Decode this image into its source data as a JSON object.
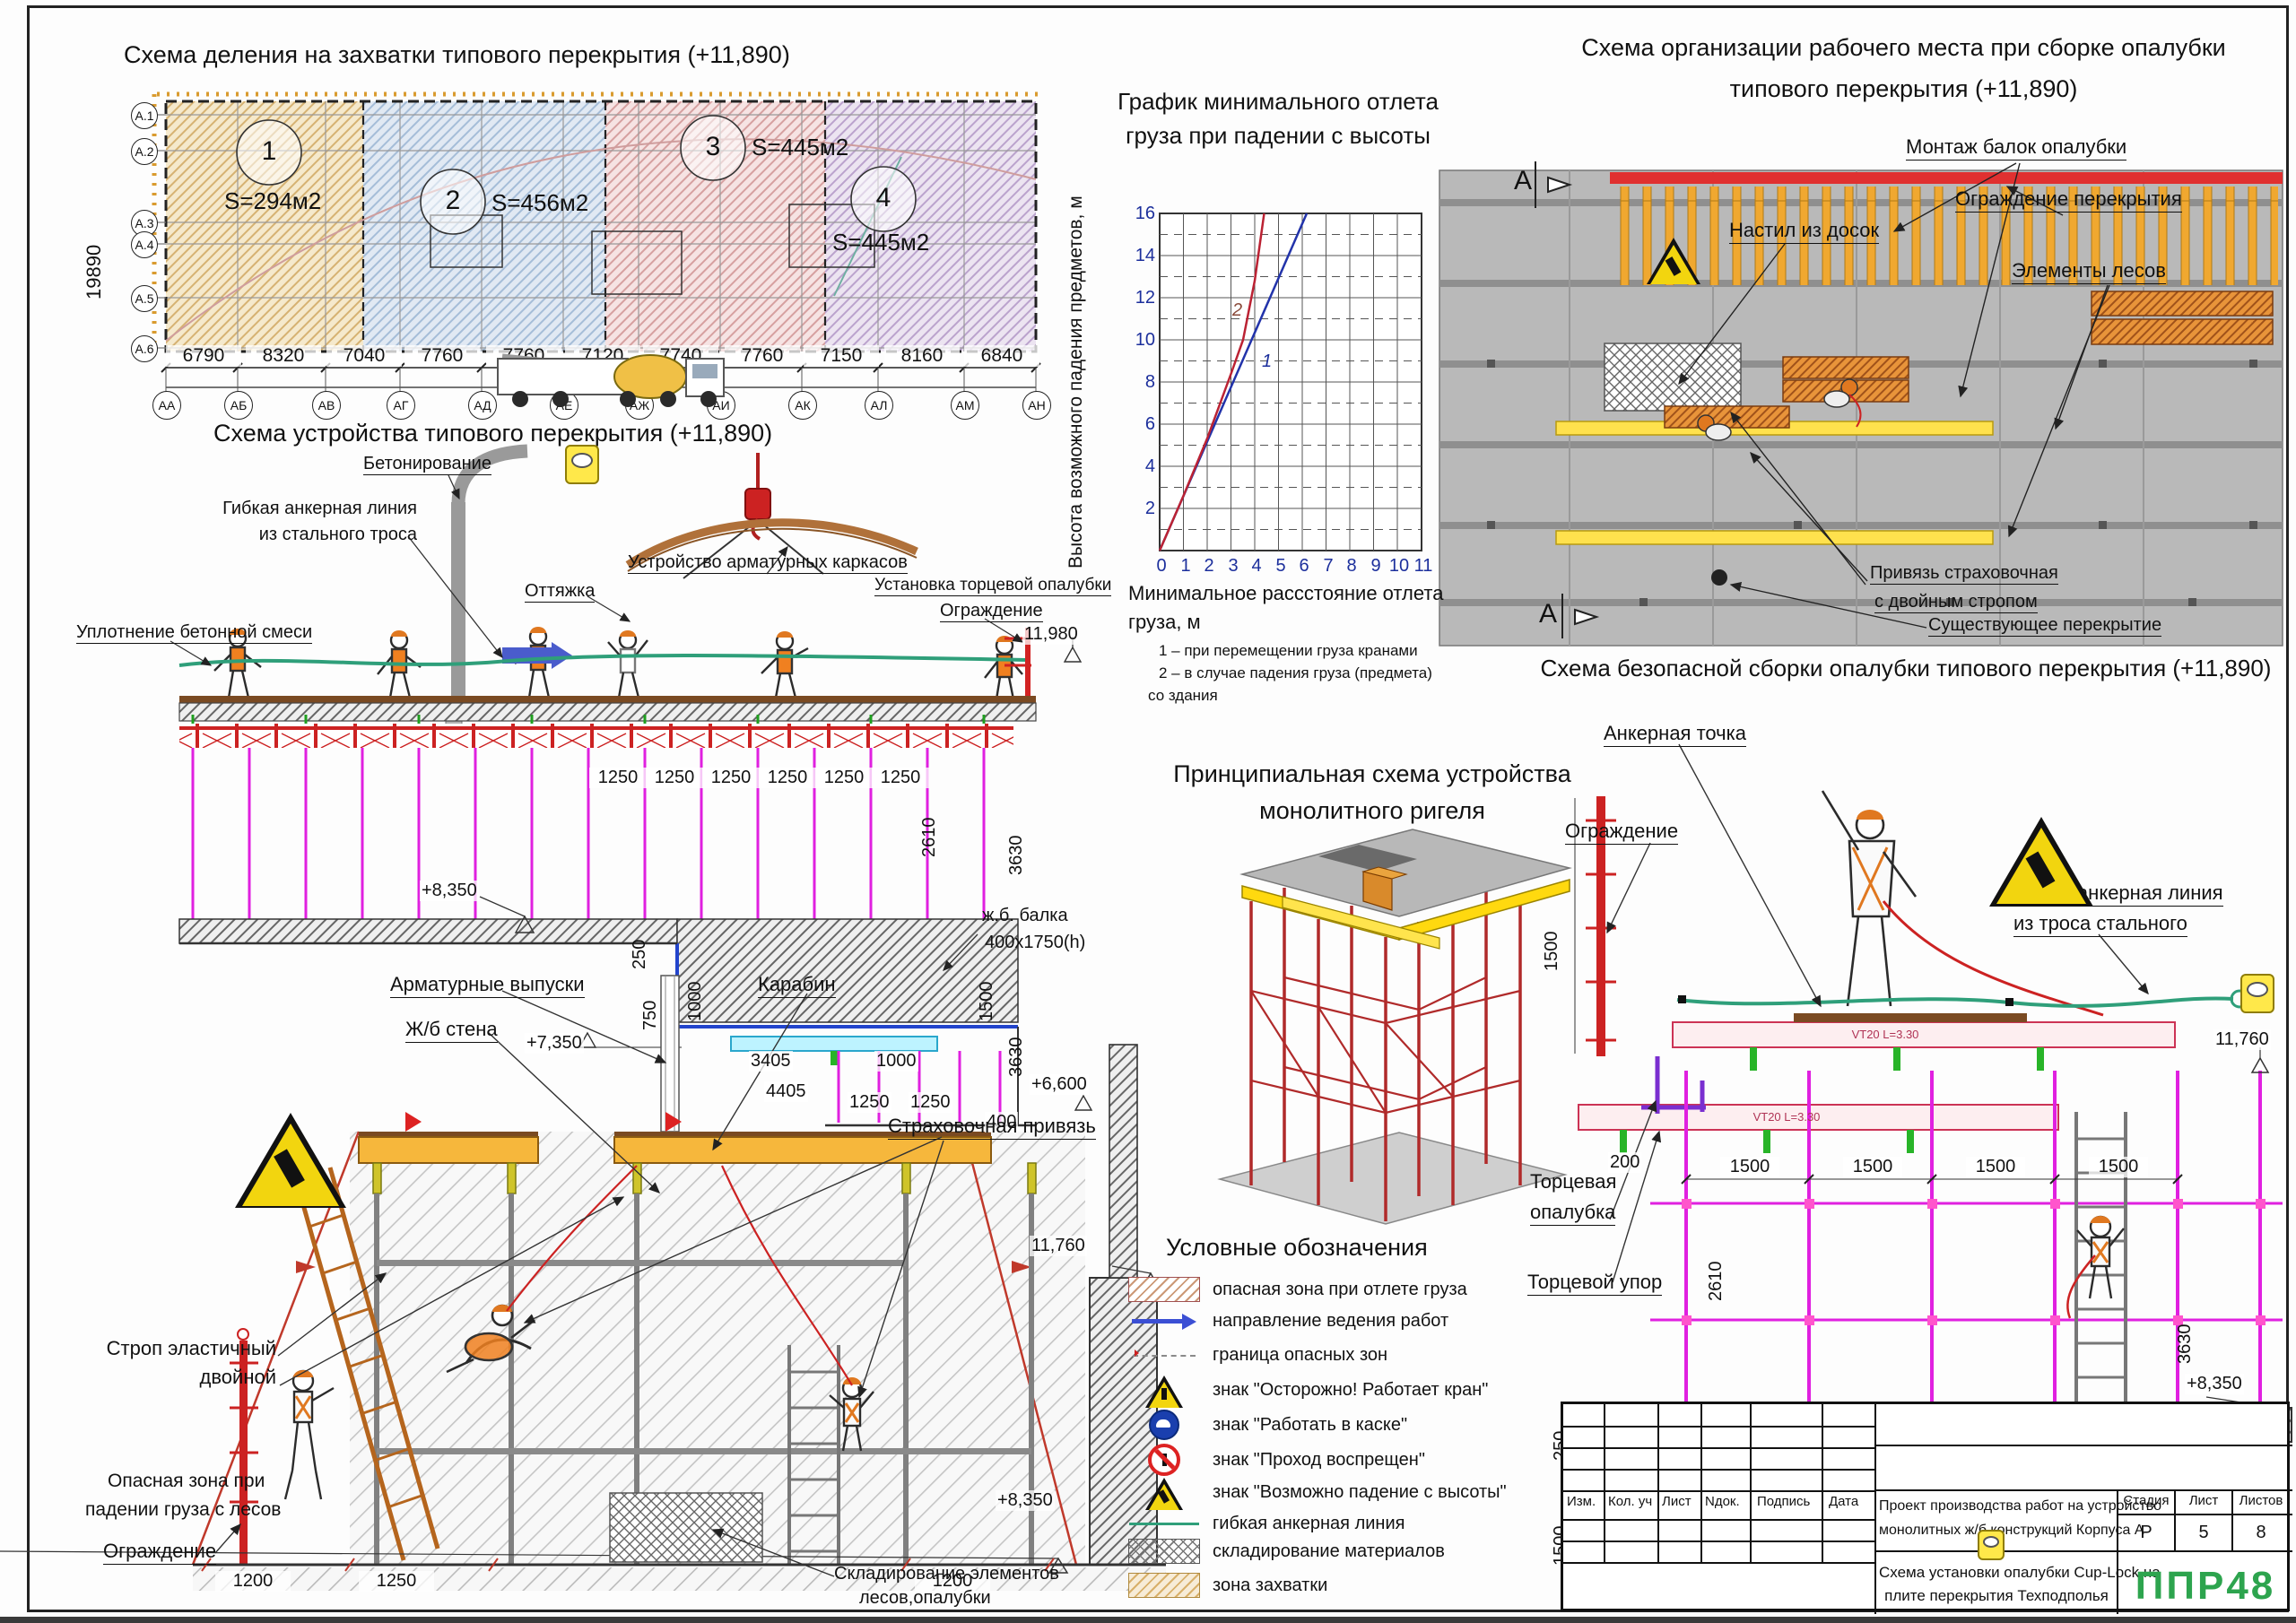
{
  "plan": {
    "title": "Схема деления на захватки типового перекрытия (+11,890)",
    "zones": [
      {
        "num": "1",
        "area": "S=294м2"
      },
      {
        "num": "2",
        "area": "S=456м2"
      },
      {
        "num": "3",
        "area": "S=445м2"
      },
      {
        "num": "4",
        "area": "S=445м2"
      }
    ],
    "left_axes": [
      "А.1",
      "А.2",
      "А.3",
      "А.4",
      "А.5",
      "А.6"
    ],
    "height_dim": "19890",
    "dims": [
      "6790",
      "8320",
      "7040",
      "7760",
      "7760",
      "7120",
      "7740",
      "7760",
      "7150",
      "8160",
      "6840"
    ],
    "total": "82440",
    "bottom_axes": [
      "АА",
      "АБ",
      "АВ",
      "АГ",
      "АД",
      "АЕ",
      "АЖ",
      "АИ",
      "АК",
      "АЛ",
      "АМ",
      "АН"
    ]
  },
  "chart": {
    "title_1": "График минимального отлета",
    "title_2": "груза при падении с высоты",
    "ylabel": "Высота возможного падения предметов, м",
    "xlabel_1": "Минимальное рассстояние отлета",
    "xlabel_2": "груза, м",
    "note_1": "1 – при перемещении груза кранами",
    "note_2": "2 – в случае падения груза (предмета)",
    "note_3": "со здания",
    "curve_label_1": "1",
    "curve_label_2": "2",
    "y_ticks": [
      "16",
      "14",
      "12",
      "10",
      "8",
      "6",
      "4",
      "2"
    ],
    "x_ticks": [
      "0",
      "1",
      "2",
      "3",
      "4",
      "5",
      "6",
      "7",
      "8",
      "9",
      "10",
      "11"
    ]
  },
  "chart_data": {
    "type": "line",
    "title": "График минимального отлета груза при падении с высоты",
    "xlabel": "Минимальное рассстояние отлета груза, м",
    "ylabel": "Высота возможного падения предметов, м",
    "xlim": [
      0,
      11
    ],
    "ylim": [
      0,
      16
    ],
    "x_ticks": [
      0,
      1,
      2,
      3,
      4,
      5,
      6,
      7,
      8,
      9,
      10,
      11
    ],
    "y_ticks": [
      0,
      2,
      4,
      6,
      8,
      10,
      12,
      14,
      16
    ],
    "grid": true,
    "legend_position": "none",
    "series": [
      {
        "name": "1 – при перемещении груза кранами",
        "x": [
          0,
          6.2
        ],
        "y": [
          0,
          16
        ]
      },
      {
        "name": "2 – в случае падения груза (предмета) со здания",
        "x": [
          0,
          1,
          2,
          3,
          3.5,
          4,
          4.4
        ],
        "y": [
          0,
          2.6,
          5.3,
          8.4,
          10,
          12.8,
          16
        ]
      }
    ]
  },
  "device": {
    "title": "Схема устройства типового перекрытия (+11,890)",
    "labels": {
      "concreting": "Бетонирование",
      "anchor_line_1": "Гибкая анкерная линия",
      "anchor_line_2": "из стального троса",
      "guy": "Оттяжка",
      "rebar": "Устройство арматурных каркасов",
      "compaction": "Уплотнение бетонной смеси",
      "end_formwork": "Установка торцевой опалубки",
      "guard": "Ограждение",
      "beam_1": "ж.б. балка",
      "beam_2": "400х1750(h)"
    },
    "levels": {
      "top": "11,980",
      "l835": "+8,350",
      "l735": "+7,350",
      "l660": "+6,600"
    },
    "dims": {
      "d1250": "1250",
      "d250": "250",
      "d750": "750",
      "d1000": "1000",
      "d3405": "3405",
      "d4405": "4405",
      "d400": "400",
      "d1500": "1500",
      "d2610": "2610",
      "d3630": "3630"
    }
  },
  "workplace": {
    "title_1": "Схема организации рабочего места при сборке опалубки",
    "title_2": "типового перекрытия (+11,890)",
    "section_mark": "А",
    "labels": {
      "mount": "Монтаж балок опалубки",
      "guard": "Ограждение перекрытия",
      "deck": "Настил из досок",
      "scaffold": "Элементы лесов",
      "harness_1": "Привязь страховочная",
      "harness_2": "с двойным стропом",
      "existing": "Существующее перекрытие"
    }
  },
  "safe": {
    "title": "Схема безопасной сборки опалубки типового перекрытия (+11,890)",
    "labels": {
      "anchor_point": "Анкерная точка",
      "guard": "Ограждение",
      "line_1": "Гибкая анкерная линия",
      "line_2": "из троса стального",
      "end_form_1": "Торцевая",
      "end_form_2": "опалубка",
      "end_stop": "Торцевой упор",
      "rc_beam_1": "ж.б. балка",
      "rc_beam_2": "400х1750(h)"
    },
    "beam_mark": "VT20 L=3.30",
    "levels": {
      "top": "11,760",
      "floor": "+8,350"
    },
    "dims": {
      "d1500": "1500",
      "d200": "200",
      "d2610": "2610",
      "d3630": "3630",
      "d250": "250",
      "d400": "400"
    },
    "section_bubble": "А.А"
  },
  "scaffold": {
    "labels": {
      "rebar": "Арматурные выпуски",
      "wall": "Ж/б стена",
      "carabiner": "Карабин",
      "harness": "Страховочная привязь",
      "sling_1": "Строп эластичный",
      "sling_2": "двойной",
      "danger_1": "Опасная зона при",
      "danger_2": "падении груза с лесов",
      "guard": "Ограждение",
      "storage_1": "Складирование элементов",
      "storage_2": "лесов,опалубки"
    },
    "levels": {
      "top": "11,760",
      "floor": "+8,350"
    },
    "dims": {
      "d1200": "1200",
      "d1250": "1250"
    }
  },
  "monolithic": {
    "title_1": "Принципиальная схема устройства",
    "title_2": "монолитного ригеля"
  },
  "legend": {
    "title": "Условные обозначения",
    "items": [
      {
        "label": "опасная зона при отлете груза"
      },
      {
        "label": "направление ведения работ"
      },
      {
        "label": "граница опасных зон"
      },
      {
        "label": "знак \"Осторожно! Работает кран\""
      },
      {
        "label": "знак \"Работать в каске\""
      },
      {
        "label": "знак \"Проход воспрещен\""
      },
      {
        "label": "знак \"Возможно падение с высоты\""
      },
      {
        "label": "гибкая анкерная линия"
      },
      {
        "label": "складирование материалов"
      },
      {
        "label": "зона захватки"
      }
    ]
  },
  "titleblock": {
    "headers": [
      "Изм.",
      "Кол. уч",
      "Лист",
      "Nдок.",
      "Подпись",
      "Дата"
    ],
    "project_1": "Проект производства работ на устройство",
    "project_2": "монолитных ж/б конструкций Корпуса А",
    "doc_1": "Схема установки опалубки Cup-Lock на",
    "doc_2": "плите перекрытия Техподполья",
    "stage_label": "Стадия",
    "sheet_label": "Лист",
    "sheets_label": "Листов",
    "stage": "Р",
    "sheet": "5",
    "sheets": "8",
    "logo": "ППР48"
  }
}
